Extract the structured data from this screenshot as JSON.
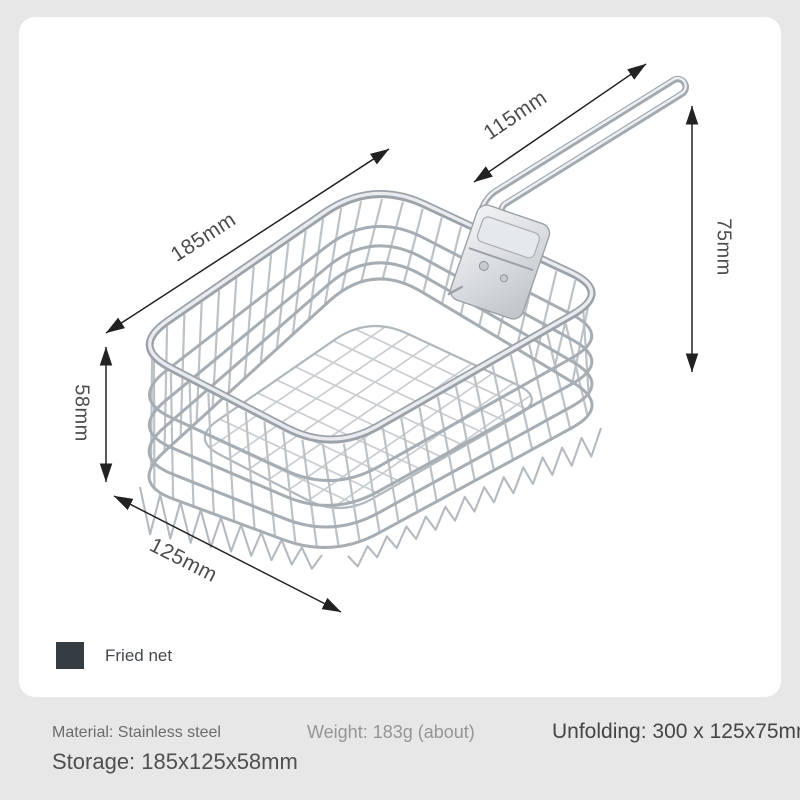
{
  "figure": {
    "dimension_labels": {
      "length": "185mm",
      "handle_length": "115mm",
      "handle_height": "75mm",
      "basket_height": "58mm",
      "width": "125mm"
    },
    "legend": {
      "label": "Fried net",
      "swatch_color": "#363d42"
    }
  },
  "specs": {
    "material": "Material: Stainless steel",
    "weight": "Weight: 183g (about)",
    "unfolding": "Unfolding: 300 x 125x75mm",
    "storage": "Storage: 185x125x58mm"
  },
  "colors": {
    "page_background": "#e7e7e7",
    "card_background": "#ffffff",
    "wire_light": "#c9cdd1",
    "wire_mid": "#b4bac0",
    "wire_dark": "#9ba2a9",
    "arrow": "#222222",
    "dimension_text": "#4d4d4d"
  }
}
